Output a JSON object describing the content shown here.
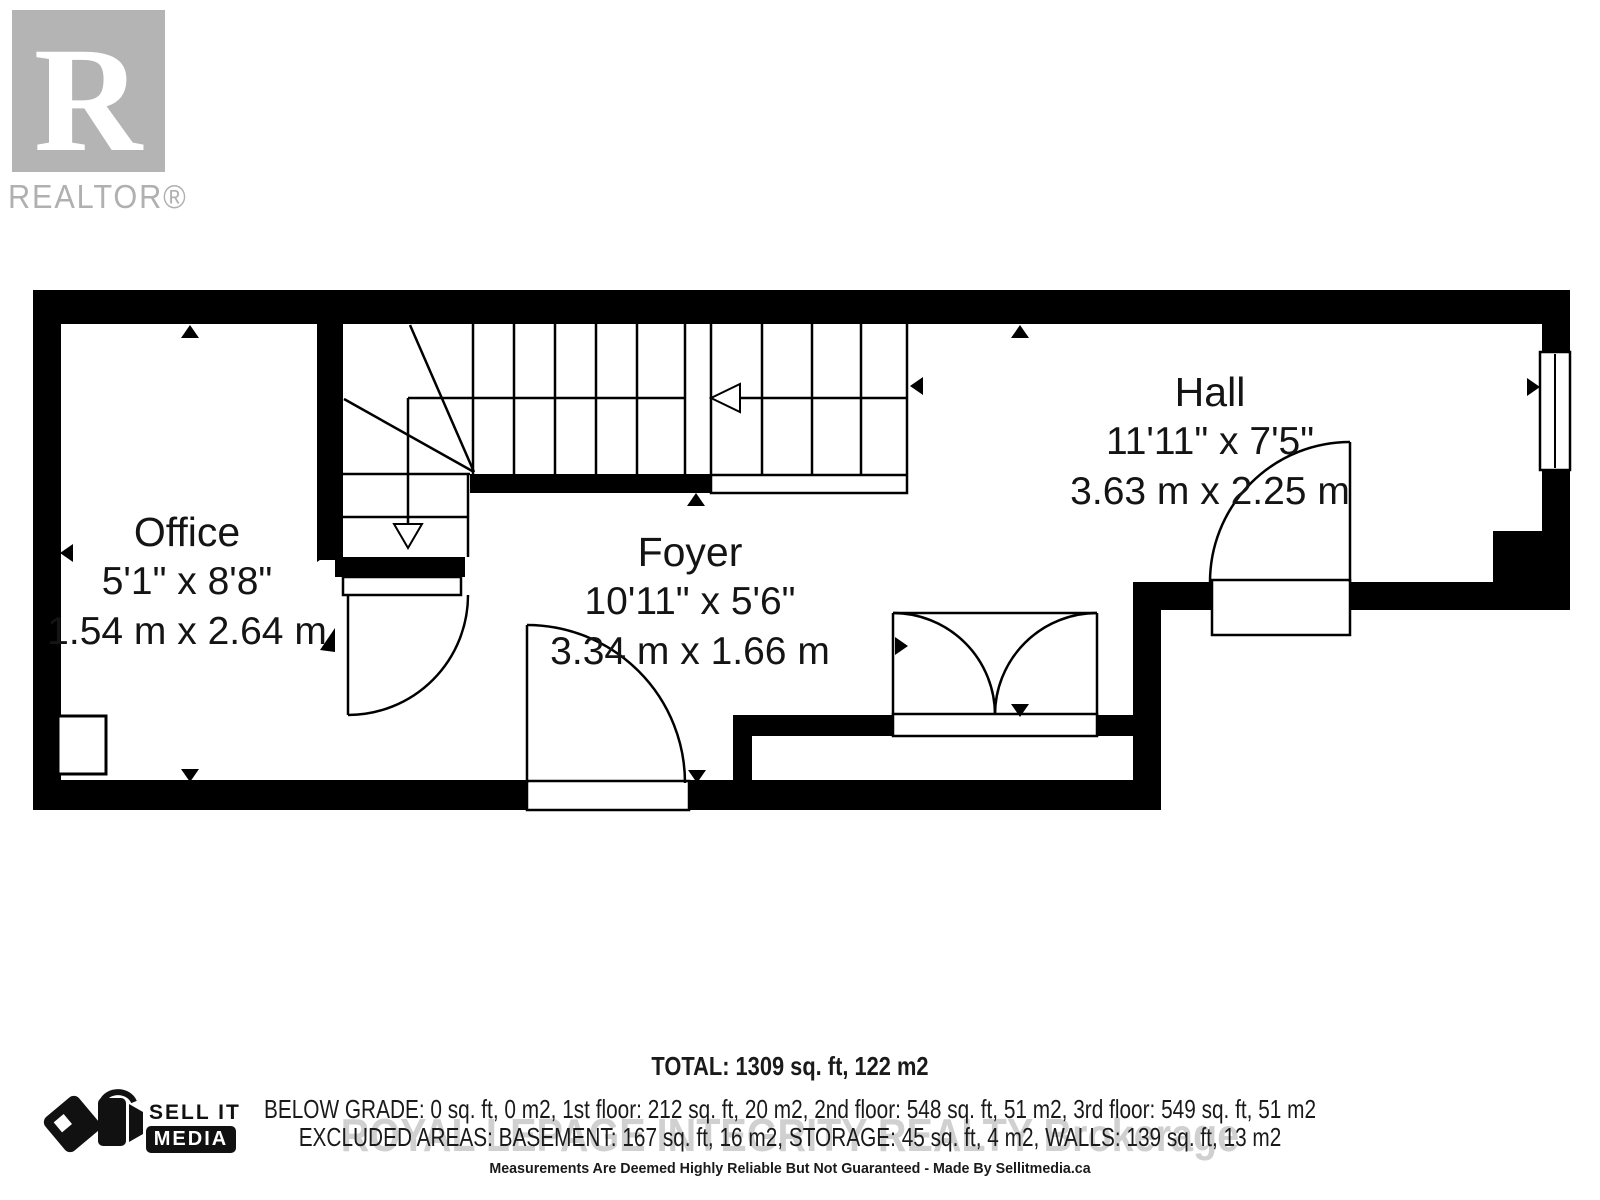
{
  "branding": {
    "realtor_logo_letter": "R",
    "realtor_logo_text": "REALTOR®",
    "sell_it": "SELL IT",
    "media": "MEDIA"
  },
  "rooms": [
    {
      "name": "Office",
      "imperial": "5'1\" x 8'8\"",
      "metric": "1.54 m x 2.64 m"
    },
    {
      "name": "Foyer",
      "imperial": "10'11\" x 5'6\"",
      "metric": "3.34 m x 1.66 m"
    },
    {
      "name": "Hall",
      "imperial": "11'11\" x 7'5\"",
      "metric": "3.63 m x 2.25 m"
    }
  ],
  "summary": {
    "total": "TOTAL: 1309 sq. ft, 122 m2",
    "below_grade": "BELOW GRADE: 0 sq. ft, 0 m2, 1st floor: 212 sq. ft, 20 m2, 2nd floor: 548 sq. ft, 51 m2, 3rd floor: 549 sq. ft, 51 m2",
    "excluded": "EXCLUDED AREAS: BASEMENT: 167 sq. ft, 16 m2, STORAGE: 45 sq. ft, 4 m2, WALLS: 139 sq. ft, 13 m2",
    "watermark": "ROYAL LEPAGE INTEGRITY REALTY  Brokerage",
    "disclaimer": "Measurements Are Deemed Highly Reliable But Not Guaranteed - Made By Sellitmedia.ca"
  },
  "colors": {
    "wall": "#000000",
    "logo_gray": "#b4b4b4",
    "text": "#141414"
  }
}
